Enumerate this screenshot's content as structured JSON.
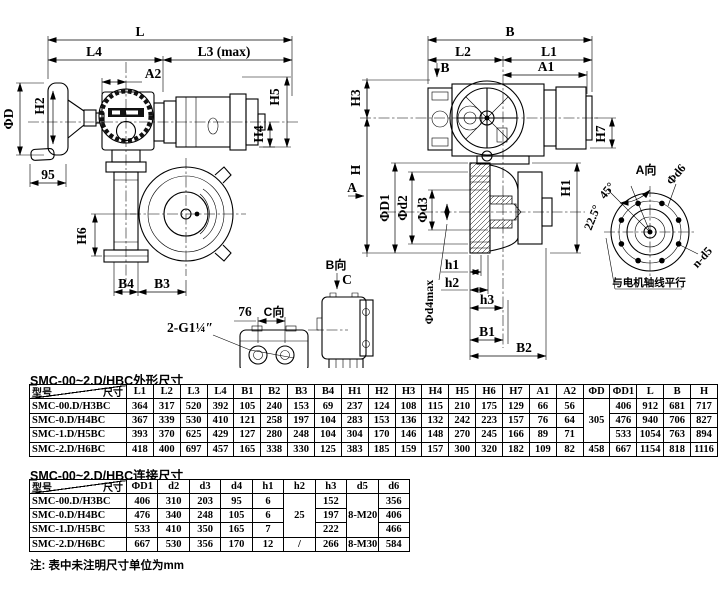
{
  "views": {
    "left": {
      "L": "L",
      "L4": "L4",
      "L3": "L3 (max)",
      "A2": "A2",
      "H2": "H2",
      "phi_d": "ΦD",
      "n95": "95",
      "H5": "H5",
      "H4": "H4",
      "H6": "H6",
      "B4": "B4",
      "B3": "B3",
      "conduit": "2-G1¼″"
    },
    "right": {
      "B": "B",
      "L2": "L2",
      "L1": "L1",
      "A1": "A1",
      "B_arrow": "B",
      "H3": "H3",
      "H": "H",
      "A_arrow": "A",
      "H7": "H7",
      "H1": "H1",
      "phi_D1": "ΦD1",
      "phi_d2": "Φd2",
      "phi_d3": "Φd3",
      "phi_d4max": "Φd4max",
      "h1": "h1",
      "h2": "h2",
      "h3": "h3",
      "B1": "B1",
      "B2": "B2",
      "a45": "45°",
      "a225": "22.5°"
    },
    "view_a": {
      "title": "A向",
      "phi_d6": "Φd6",
      "n_d5": "n-d5",
      "parallel_note": "与电机轴线平行"
    },
    "view_b": {
      "title": "B向",
      "c_arrow": "C"
    },
    "view_c": {
      "title": "C向",
      "w76": "76"
    }
  },
  "table1": {
    "title": "SMC-00~2.D/HBC外形尺寸",
    "corner": {
      "top": "尺寸",
      "bottom": "型号"
    },
    "columns": [
      "L1",
      "L2",
      "L3",
      "L4",
      "B1",
      "B2",
      "B3",
      "B4",
      "H1",
      "H2",
      "H3",
      "H4",
      "H5",
      "H6",
      "H7",
      "A1",
      "A2",
      "ΦD",
      "ΦD1",
      "L",
      "B",
      "H"
    ],
    "rows": [
      {
        "model": "SMC-00.D/H3BC",
        "cells": [
          "364",
          "317",
          "520",
          "392",
          "105",
          "240",
          "153",
          "69",
          "237",
          "124",
          "108",
          "115",
          "210",
          "175",
          "129",
          "66",
          "56",
          {
            "v": "305",
            "rs": 3
          },
          "406",
          "912",
          "681",
          "717"
        ]
      },
      {
        "model": "SMC-0.D/H4BC",
        "cells": [
          "367",
          "339",
          "530",
          "410",
          "121",
          "258",
          "197",
          "104",
          "283",
          "153",
          "136",
          "132",
          "242",
          "223",
          "157",
          "76",
          "64",
          "476",
          "940",
          "706",
          "827"
        ]
      },
      {
        "model": "SMC-1.D/H5BC",
        "cells": [
          "393",
          "370",
          "625",
          "429",
          "127",
          "280",
          "248",
          "104",
          "304",
          "170",
          "146",
          "148",
          "270",
          "245",
          "166",
          "89",
          "71",
          "533",
          "1054",
          "763",
          "894"
        ]
      },
      {
        "model": "SMC-2.D/H6BC",
        "cells": [
          "418",
          "400",
          "697",
          "457",
          "165",
          "338",
          "330",
          "125",
          "383",
          "185",
          "159",
          "157",
          "300",
          "320",
          "182",
          "109",
          "82",
          "458",
          "667",
          "1154",
          "818",
          "1116"
        ]
      }
    ]
  },
  "table2": {
    "title": "SMC-00~2.D/HBC连接尺寸",
    "corner": {
      "top": "尺寸",
      "bottom": "型号"
    },
    "columns": [
      "ΦD1",
      "d2",
      "d3",
      "d4",
      "h1",
      "h2",
      "h3",
      "d5",
      "d6"
    ],
    "rows": [
      {
        "model": "SMC-00.D/H3BC",
        "cells": [
          "406",
          "310",
          "203",
          "95",
          "6",
          {
            "v": "25",
            "rs": 3
          },
          "152",
          {
            "v": "8-M20",
            "rs": 3
          },
          "356"
        ]
      },
      {
        "model": "SMC-0.D/H4BC",
        "cells": [
          "476",
          "340",
          "248",
          "105",
          "6",
          "197",
          "406"
        ]
      },
      {
        "model": "SMC-1.D/H5BC",
        "cells": [
          "533",
          "410",
          "350",
          "165",
          "7",
          "222",
          "466"
        ]
      },
      {
        "model": "SMC-2.D/H6BC",
        "cells": [
          "667",
          "530",
          "356",
          "170",
          "12",
          "/",
          "266",
          "8-M30",
          "584"
        ]
      }
    ]
  },
  "note": "注: 表中未注明尺寸单位为mm"
}
